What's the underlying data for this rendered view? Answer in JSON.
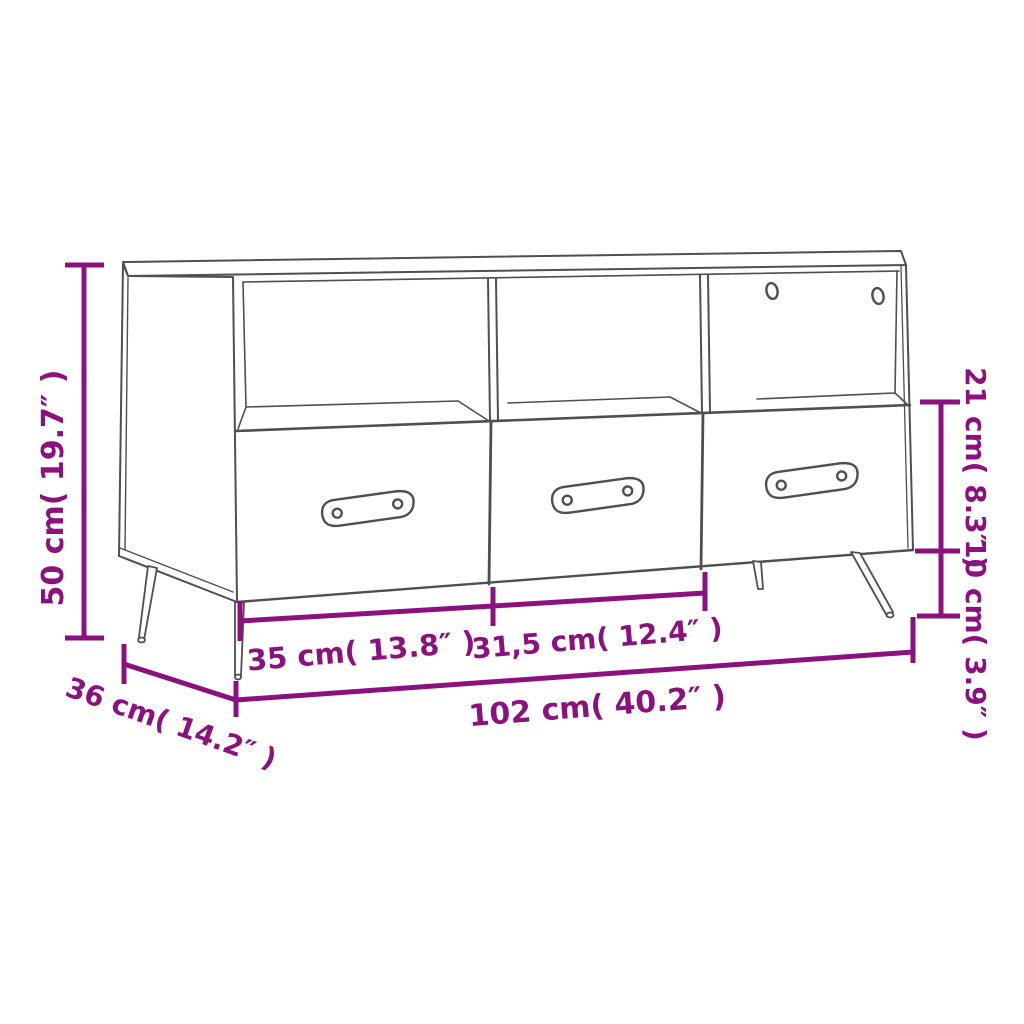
{
  "diagram": {
    "title": "TV cabinet dimension diagram",
    "product": "TV cabinet with 3 open compartments and 3 drawers on splayed metal legs",
    "colors": {
      "background": "#ffffff",
      "outline": "#4f4f4f",
      "dimension": "#8B127E"
    },
    "labels": {
      "height": "50 cm( 19.7″ )",
      "opening_height": "21 cm( 8.3″ )",
      "leg_height": "10 cm( 3.9″ )",
      "left_drawer_width": "35 cm( 13.8″ )",
      "middle_drawer_width": "31,5 cm( 12.4″ )",
      "total_width": "102 cm( 40.2″ )",
      "depth": "36 cm( 14.2″ )"
    }
  }
}
